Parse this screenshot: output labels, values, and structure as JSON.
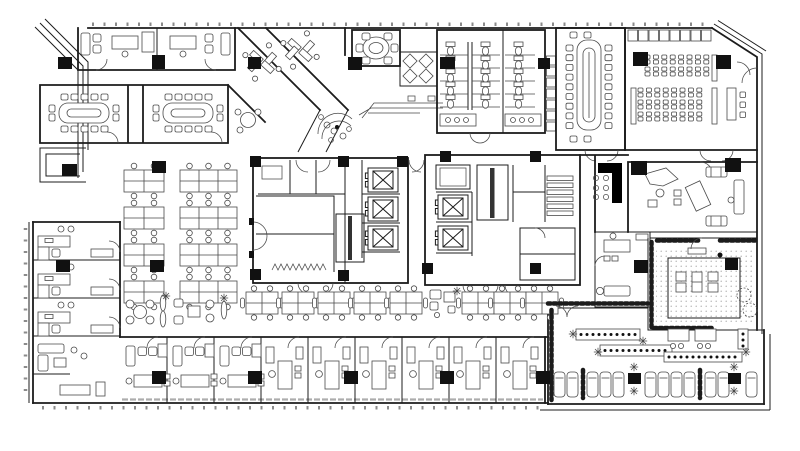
{
  "meta": {
    "kind": "architectural-floor-plan",
    "description": "Black-and-white CAD-style office floor plan, no text labels visible"
  },
  "palette": {
    "background": "#ffffff",
    "wall": "#1c1c1c",
    "furniture": "#4a4a4a",
    "column": "#111111",
    "paving_line": "#d8d8d8",
    "gravel_dot": "#9a9a9a",
    "hatch": "#8a8a8a",
    "window_tick": "#8b8b8b"
  },
  "zones": [
    "entrance-canopy",
    "top-offices",
    "meeting-room-west-a",
    "meeting-room-west-b",
    "angled-team-rooms",
    "small-meeting-round-table",
    "small-meeting-square-tables",
    "reception",
    "entry-counter",
    "restrooms",
    "lockers",
    "boardroom",
    "training-room",
    "podium",
    "core-west-elevators",
    "core-west-stair",
    "core-east-elevators",
    "core-east-stair",
    "open-office-west",
    "bench-desk-row",
    "breakout-seating",
    "perimeter-offices-west",
    "perimeter-offices-south",
    "executive-office",
    "lounge-seating",
    "coffee-counter",
    "manager-room",
    "courtyard-garden",
    "roof-terrace",
    "terrace-bar-counters",
    "sun-loungers",
    "planters",
    "structural-columns"
  ]
}
